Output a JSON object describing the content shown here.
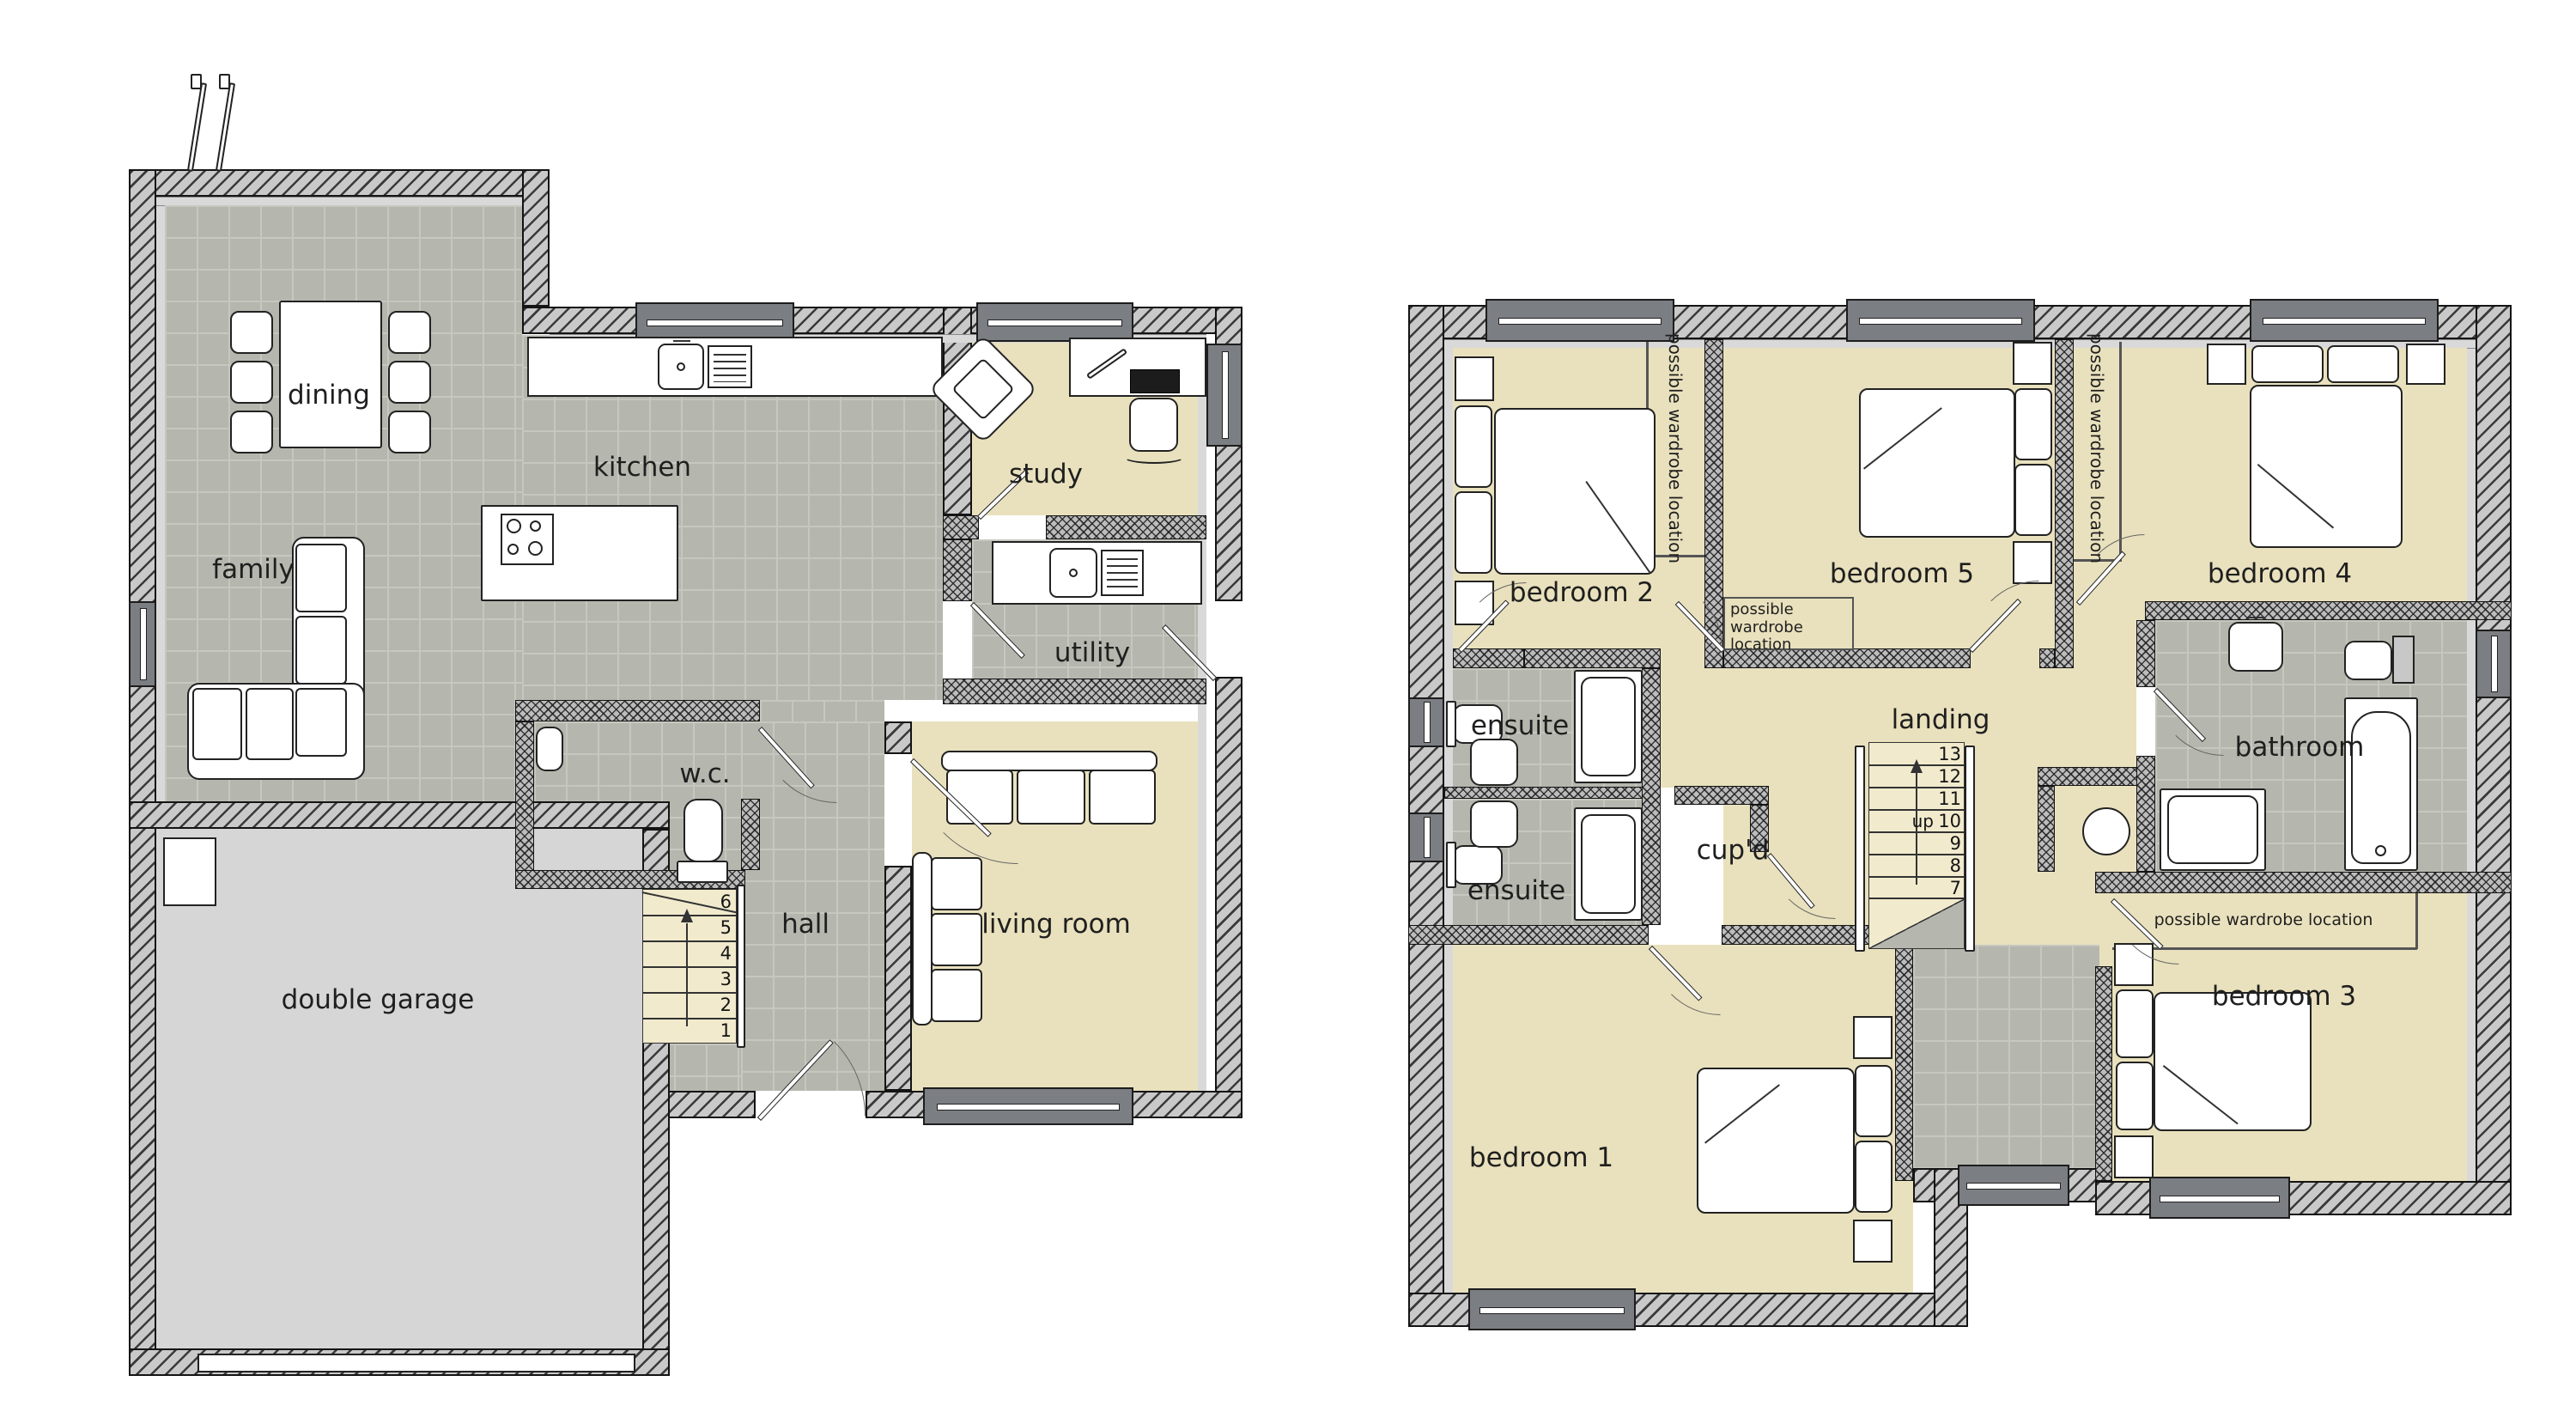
{
  "palette": {
    "floor_tile_gray": "#b5b7ae",
    "floor_grout": "#c6c8bf",
    "floor_beige": "#e9e1bd",
    "floor_stairs_beige": "#f1eacd",
    "floor_garage_gray": "#d6d6d7",
    "wall_outline": "#141414",
    "wall_hatch_gray": "#c9c9c9",
    "inner_lining_gray": "#d9d9d9",
    "window_gray": "#7b7e82",
    "furniture_white": "#ffffff",
    "label_color": "#1f1f1f"
  },
  "ground_floor": {
    "rooms": {
      "dining": "dining",
      "family": "family",
      "kitchen": "kitchen",
      "study": "study",
      "utility": "utility",
      "wc": "w.c.",
      "hall": "hall",
      "living_room": "living room",
      "double_garage": "double garage"
    },
    "stairs": {
      "steps": [
        "6",
        "5",
        "4",
        "3",
        "2",
        "1"
      ]
    }
  },
  "first_floor": {
    "rooms": {
      "bedroom_1": "bedroom 1",
      "bedroom_2": "bedroom 2",
      "bedroom_3": "bedroom 3",
      "bedroom_4": "bedroom 4",
      "bedroom_5": "bedroom 5",
      "ensuite_top": "ensuite",
      "ensuite_bottom": "ensuite",
      "landing": "landing",
      "cupboard": "cup'd",
      "bathroom": "bathroom"
    },
    "stairs": {
      "steps": [
        "13",
        "12",
        "11",
        "10",
        "9",
        "8",
        "7"
      ],
      "up_label": "up"
    },
    "notes": {
      "wardrobe": "possible wardrobe location"
    }
  }
}
